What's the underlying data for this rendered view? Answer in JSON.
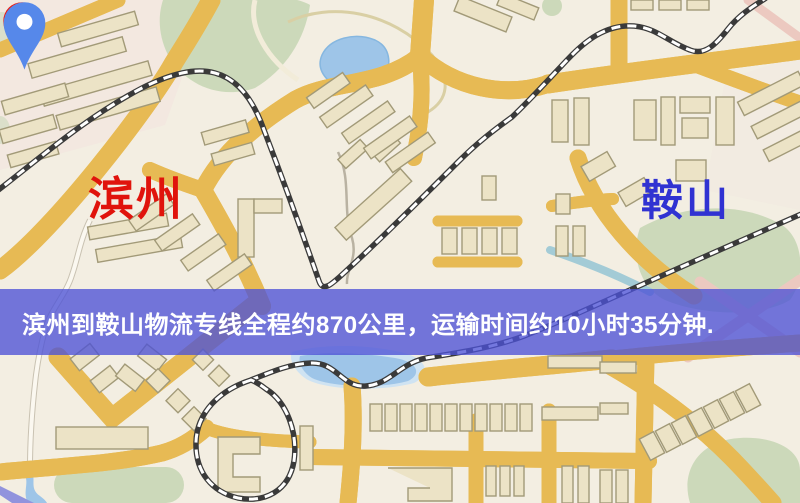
{
  "banner": {
    "text": "滨州到鞍山物流专线全程约870公里，运输时间约10小时35分钟."
  },
  "markers": {
    "origin": {
      "label": "滨州"
    },
    "destination": {
      "label": "鞍山"
    }
  },
  "colors": {
    "origin_pin": "#ea1c14",
    "origin_label": "#e0130c",
    "dest_pin": "#5688ea",
    "dest_label": "#3032d2",
    "banner_bg": "rgba(77,82,214,0.78)",
    "banner_text": "#ffffff",
    "road": "#f5cc68",
    "road_casing": "#e7ba54",
    "building": "#ece3c6",
    "building_line": "#a29a78",
    "green": "#ccd9ba",
    "water": "#9ec5e8",
    "rail": "#3a3a3a",
    "pink": "#ecc9c0",
    "map_bg": "#f3eee2"
  }
}
